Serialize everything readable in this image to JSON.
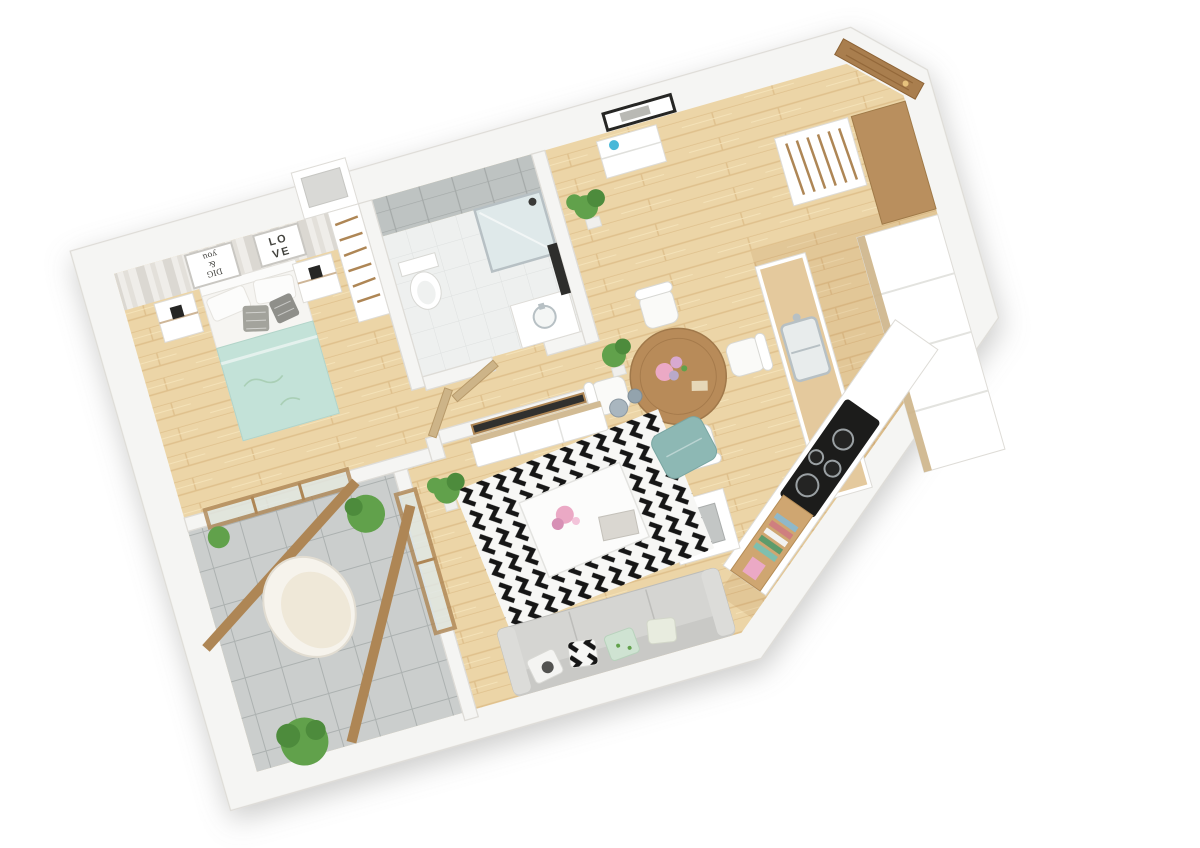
{
  "scene": {
    "description": "3D rendered top-down cutaway floor plan of a one-bedroom apartment with balcony",
    "rooms": [
      "bedroom",
      "bathroom",
      "hallway",
      "entry",
      "kitchen",
      "dining area",
      "living room",
      "balcony"
    ],
    "objects": [
      "striped accent wall",
      "framed wall art",
      "double bed",
      "nightstands with lamps",
      "open wardrobe with hangers",
      "walk-in shower",
      "toilet",
      "bathroom vanity",
      "bathroom door",
      "entrance door",
      "hallway console",
      "potted plants",
      "entry closet with hangers",
      "kitchen cabinets",
      "kitchen counter with sink",
      "cooktop with four burners",
      "round dining table",
      "four dining chairs",
      "flower vase",
      "ventilation shaft",
      "TV wall with television",
      "TV cabinet",
      "decorative vases",
      "black and white chevron rug",
      "white coffee table",
      "teal pouf",
      "gray sofa with cushions",
      "bench with books and pink box",
      "egg chair",
      "garden shrubs",
      "wooden glazed balcony doors"
    ]
  },
  "art": {
    "dig_line1": "DIG",
    "dig_line2": "&",
    "dig_line3": "you",
    "love_line1": "LO",
    "love_line2": "VE"
  },
  "palette": {
    "wall": "#f5f5f3",
    "wall_edge": "#dedcd7",
    "floor_wood": "#ecd5a7",
    "wood_grain": "#dfc08c",
    "balcony_tile": "#cbcecd",
    "balcony_line": "#a7acab",
    "bath_floor": "#eef0ef",
    "bath_tile": "#bec3c2",
    "bath_tile_line": "#a4a9a8",
    "glass": "#dfe9ea",
    "door_wood": "#a97e4e",
    "door_light": "#cdb488",
    "frame_wood": "#ae8655",
    "blanket": "#c3e2d8",
    "pouf": "#8db8b4",
    "sofa": "#d5d5d2",
    "rug_dark": "#161616",
    "rug_light": "#f7f7f5",
    "pink": "#eba9c5",
    "green": "#61a14b",
    "green_dark": "#4d8b3c",
    "steel": "#b7c0c4",
    "black": "#262624",
    "white": "#ffffff",
    "table_wood": "#b88b59",
    "stripe_a": "#efede9",
    "stripe_b": "#dbd8d2",
    "kitchen_tint": "rgba(170,115,55,0.14)"
  }
}
